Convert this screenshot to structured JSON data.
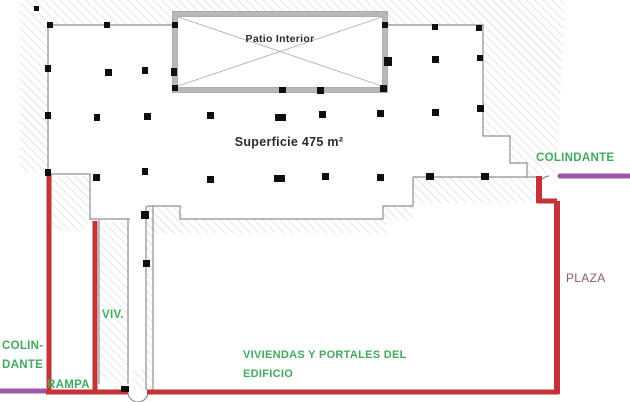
{
  "plan": {
    "title": "Floor plan - Superficie 475 m2",
    "colors": {
      "boundary_red": "#c53237",
      "colindante_purple": "#9c58a4",
      "label_green": "#43a95e",
      "plaza_text": "#8c5a73",
      "text_dark": "#2b2b2b",
      "column_black": "#0f0f0f",
      "wall_gray": "#b8b8b8",
      "line_gray": "#8f8f8f",
      "hatch_gray": "#cdcdcd"
    },
    "labels": [
      {
        "name": "label-patio-interior",
        "text": "Patio Interior",
        "x": 280,
        "y": 42,
        "size": 10.5,
        "weight": "bold",
        "color": "text_dark",
        "anchor": "middle"
      },
      {
        "name": "label-superficie",
        "text": "Superficie 475 m²",
        "x": 289,
        "y": 146,
        "size": 12.5,
        "weight": "bold",
        "color": "text_dark",
        "anchor": "middle"
      },
      {
        "name": "label-colindante-right",
        "text": "COLINDANTE",
        "x": 536,
        "y": 161,
        "size": 11.5,
        "weight": "bold",
        "color": "label_green",
        "anchor": "start"
      },
      {
        "name": "label-colindante-left-line1",
        "text": "COLIN-",
        "x": 2,
        "y": 349,
        "size": 11.5,
        "weight": "bold",
        "color": "label_green",
        "anchor": "start"
      },
      {
        "name": "label-colindante-left-line2",
        "text": "DANTE",
        "x": 2,
        "y": 368,
        "size": 11.5,
        "weight": "bold",
        "color": "label_green",
        "anchor": "start"
      },
      {
        "name": "label-rampa",
        "text": "RAMPA",
        "x": 47,
        "y": 388,
        "size": 11.5,
        "weight": "bold",
        "color": "label_green",
        "anchor": "start"
      },
      {
        "name": "label-viv",
        "text": "VIV.",
        "x": 102,
        "y": 318,
        "size": 11.5,
        "weight": "bold",
        "color": "label_green",
        "anchor": "start"
      },
      {
        "name": "label-viviendas-line1",
        "text": "VIVIENDAS Y PORTALES DEL",
        "x": 243,
        "y": 358,
        "size": 11,
        "weight": "bold",
        "color": "label_green",
        "anchor": "start"
      },
      {
        "name": "label-viviendas-line2",
        "text": "EDIFICIO",
        "x": 243,
        "y": 377,
        "size": 11,
        "weight": "bold",
        "color": "label_green",
        "anchor": "start"
      },
      {
        "name": "label-plaza",
        "text": "PLAZA",
        "x": 566,
        "y": 282,
        "size": 12,
        "weight": "normal",
        "color": "plaza_text",
        "anchor": "start"
      }
    ],
    "red_boundary_segments": [
      {
        "name": "red-left-ramp-line",
        "x1": 49,
        "y1": 174,
        "x2": 49,
        "y2": 394,
        "w": 5
      },
      {
        "name": "red-viv-line",
        "x1": 95,
        "y1": 221,
        "x2": 95,
        "y2": 394,
        "w": 5
      },
      {
        "name": "red-bottom-left",
        "x1": 46,
        "y1": 392,
        "x2": 128,
        "y2": 392,
        "w": 5
      },
      {
        "name": "red-bottom-main",
        "x1": 147,
        "y1": 392,
        "x2": 559,
        "y2": 392,
        "w": 5
      },
      {
        "name": "red-top-right-drop",
        "x1": 539,
        "y1": 176,
        "x2": 539,
        "y2": 203,
        "w": 6
      },
      {
        "name": "red-top-right-jog",
        "x1": 537,
        "y1": 201,
        "x2": 557,
        "y2": 201,
        "w": 5
      },
      {
        "name": "red-right-plaza-line",
        "x1": 557,
        "y1": 201,
        "x2": 557,
        "y2": 394,
        "w": 6
      }
    ],
    "purple_boundary_segments": [
      {
        "name": "purple-colindante-bottom-left",
        "x1": 0,
        "y1": 391,
        "x2": 46,
        "y2": 391,
        "w": 5,
        "cap": "butt"
      },
      {
        "name": "purple-colindante-right",
        "x1": 560,
        "y1": 176,
        "x2": 629,
        "y2": 176,
        "w": 5,
        "cap": "round"
      }
    ],
    "columns": [
      {
        "x": 34,
        "y": 6,
        "w": 5,
        "h": 5
      },
      {
        "x": 47,
        "y": 22,
        "w": 6,
        "h": 6
      },
      {
        "x": 104,
        "y": 22,
        "w": 6,
        "h": 6
      },
      {
        "x": 172,
        "y": 22,
        "w": 6,
        "h": 6
      },
      {
        "x": 382,
        "y": 22,
        "w": 6,
        "h": 6
      },
      {
        "x": 432,
        "y": 24,
        "w": 6,
        "h": 6
      },
      {
        "x": 476,
        "y": 25,
        "w": 6,
        "h": 6
      },
      {
        "x": 45,
        "y": 65,
        "w": 6,
        "h": 7
      },
      {
        "x": 105,
        "y": 69,
        "w": 7,
        "h": 7
      },
      {
        "x": 142,
        "y": 67,
        "w": 6,
        "h": 7
      },
      {
        "x": 171,
        "y": 68,
        "w": 6,
        "h": 8
      },
      {
        "x": 384,
        "y": 57,
        "w": 8,
        "h": 9
      },
      {
        "x": 432,
        "y": 56,
        "w": 7,
        "h": 7
      },
      {
        "x": 477,
        "y": 55,
        "w": 6,
        "h": 6
      },
      {
        "x": 172,
        "y": 85,
        "w": 6,
        "h": 6
      },
      {
        "x": 279,
        "y": 87,
        "w": 7,
        "h": 6
      },
      {
        "x": 317,
        "y": 87,
        "w": 7,
        "h": 7
      },
      {
        "x": 380,
        "y": 85,
        "w": 7,
        "h": 7
      },
      {
        "x": 45,
        "y": 112,
        "w": 6,
        "h": 7
      },
      {
        "x": 94,
        "y": 114,
        "w": 6,
        "h": 7
      },
      {
        "x": 144,
        "y": 113,
        "w": 7,
        "h": 7
      },
      {
        "x": 207,
        "y": 112,
        "w": 7,
        "h": 7
      },
      {
        "x": 275,
        "y": 114,
        "w": 11,
        "h": 7
      },
      {
        "x": 319,
        "y": 111,
        "w": 7,
        "h": 7
      },
      {
        "x": 377,
        "y": 110,
        "w": 7,
        "h": 7
      },
      {
        "x": 432,
        "y": 109,
        "w": 7,
        "h": 7
      },
      {
        "x": 477,
        "y": 105,
        "w": 7,
        "h": 7
      },
      {
        "x": 45,
        "y": 169,
        "w": 6,
        "h": 7
      },
      {
        "x": 93,
        "y": 174,
        "w": 7,
        "h": 7
      },
      {
        "x": 142,
        "y": 168,
        "w": 6,
        "h": 7
      },
      {
        "x": 207,
        "y": 176,
        "w": 7,
        "h": 7
      },
      {
        "x": 274,
        "y": 175,
        "w": 11,
        "h": 7
      },
      {
        "x": 322,
        "y": 173,
        "w": 7,
        "h": 7
      },
      {
        "x": 377,
        "y": 174,
        "w": 7,
        "h": 7
      },
      {
        "x": 426,
        "y": 173,
        "w": 8,
        "h": 7
      },
      {
        "x": 481,
        "y": 173,
        "w": 8,
        "h": 7
      },
      {
        "x": 141,
        "y": 211,
        "w": 8,
        "h": 8
      },
      {
        "x": 143,
        "y": 260,
        "w": 7,
        "h": 7
      },
      {
        "x": 121,
        "y": 386,
        "w": 8,
        "h": 6
      }
    ]
  }
}
